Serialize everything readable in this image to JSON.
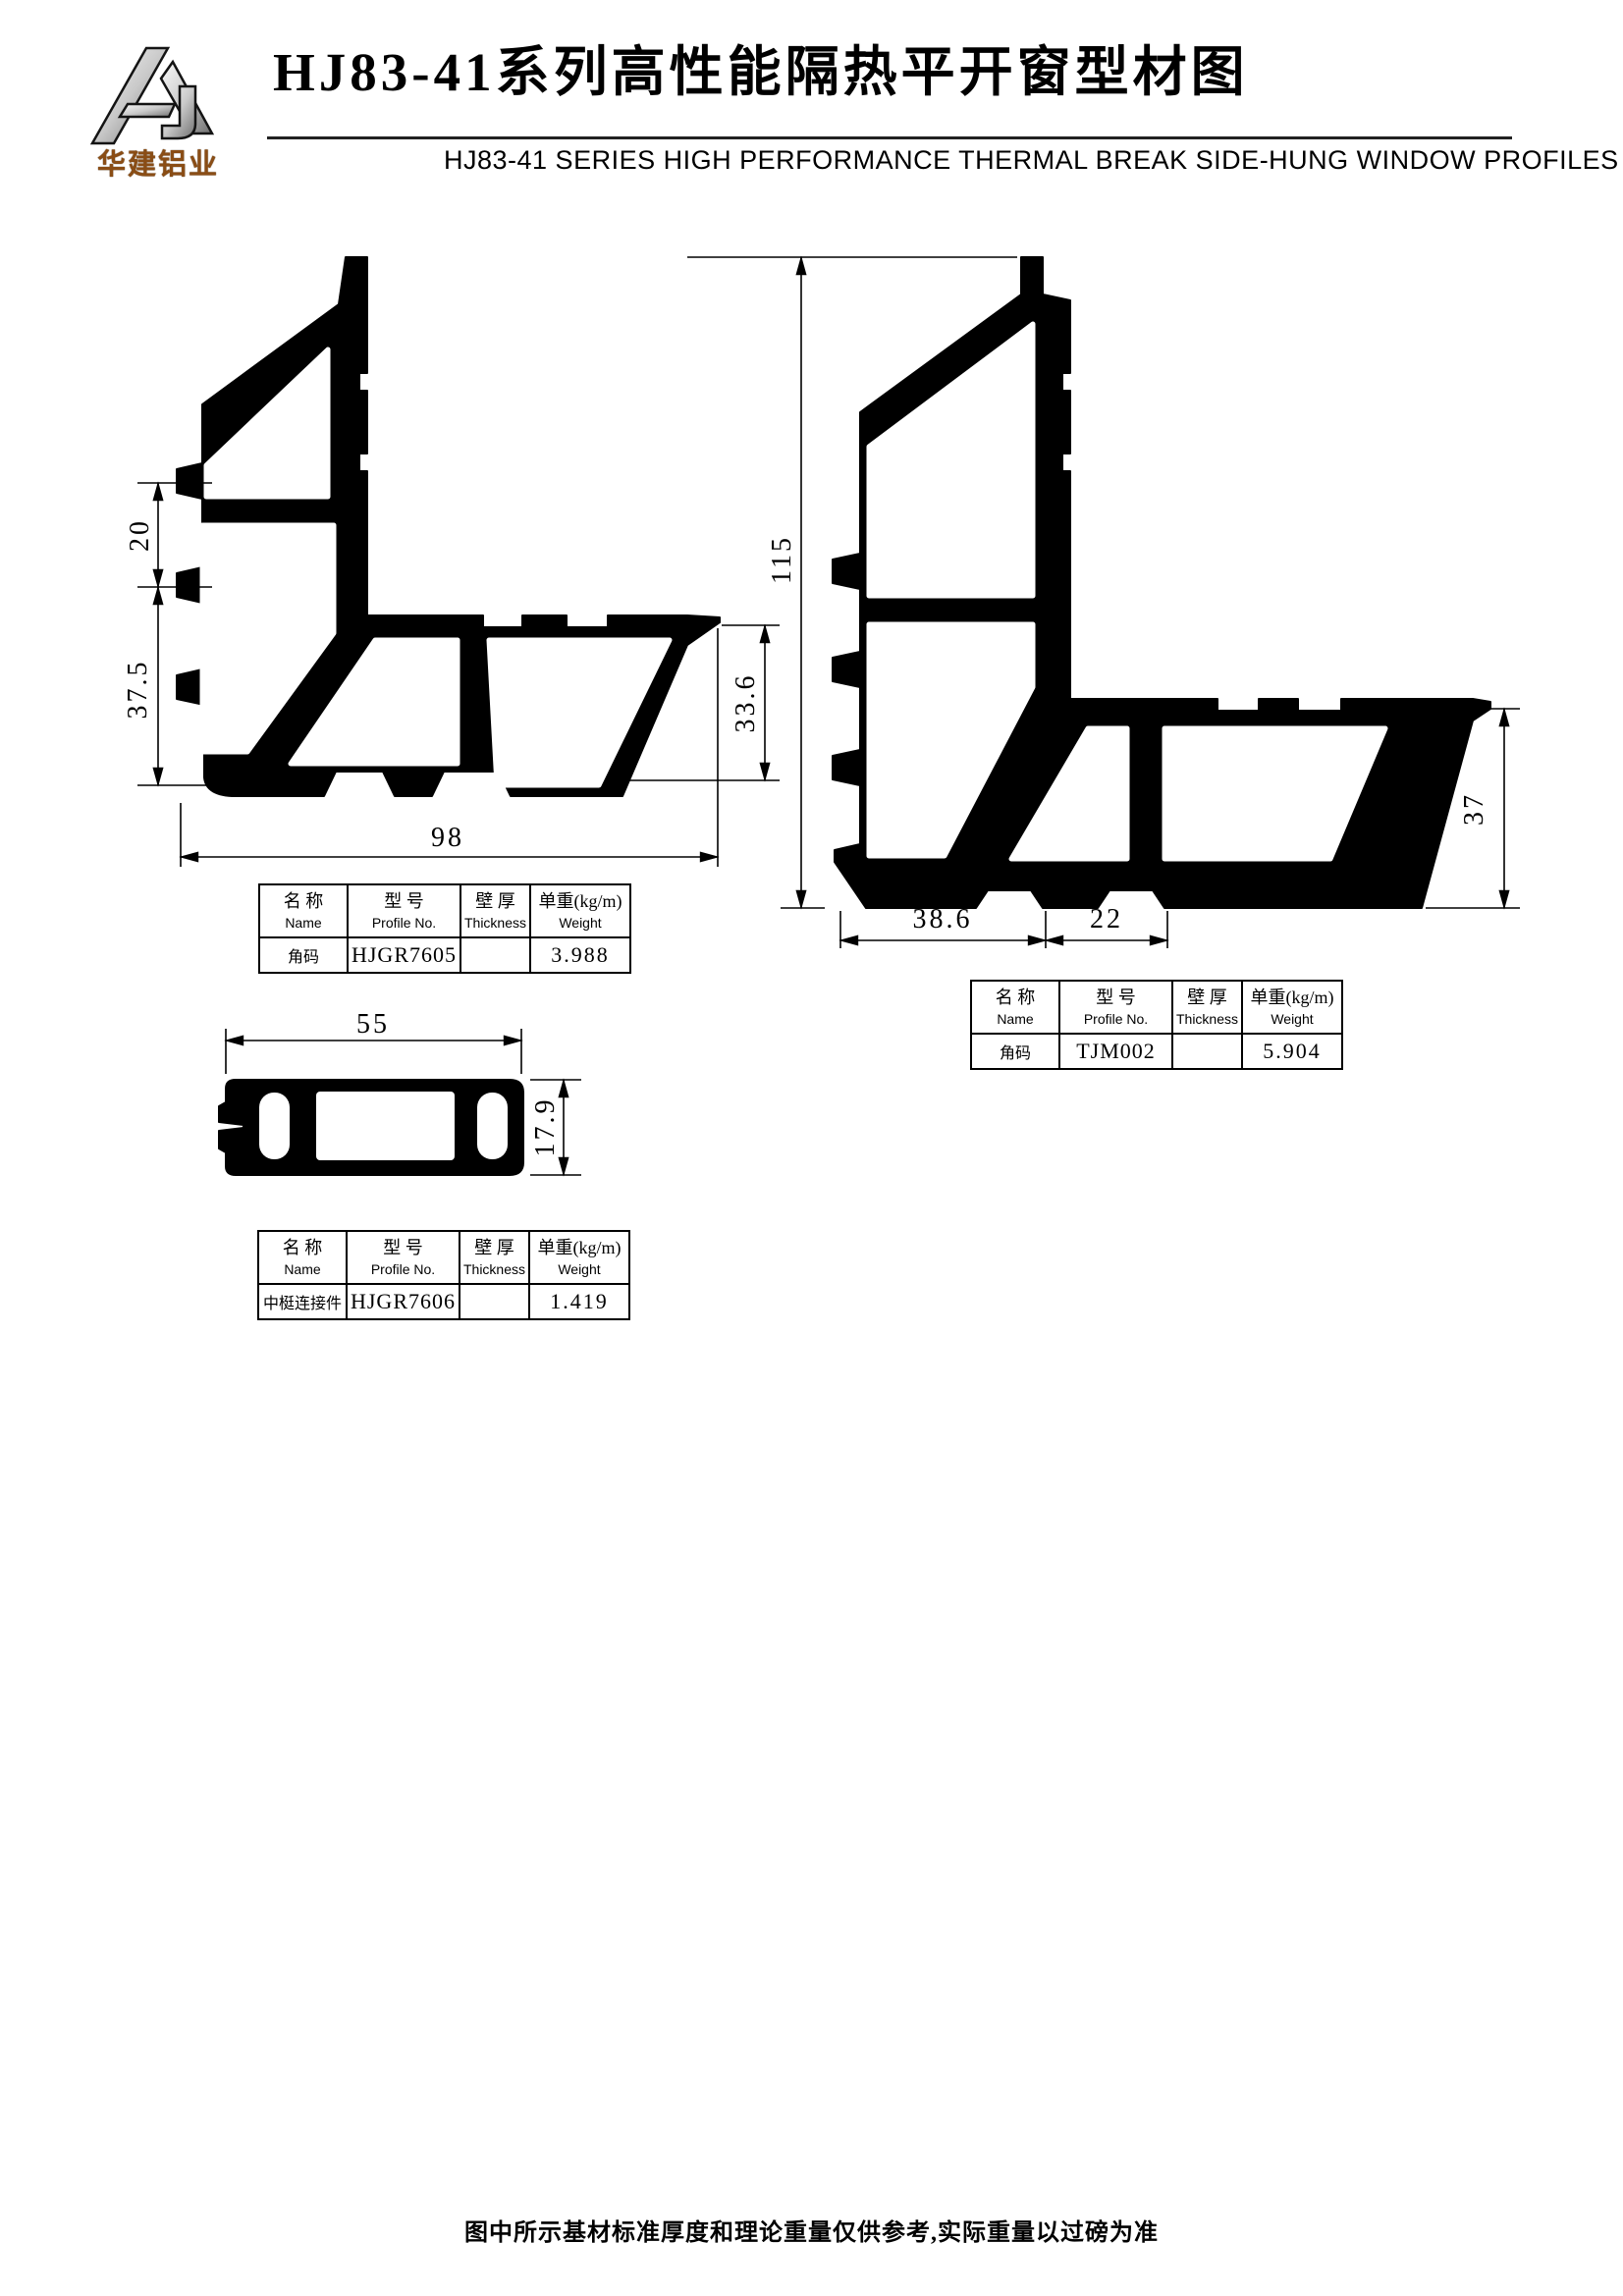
{
  "header": {
    "logo_text": "华建铝业",
    "title": "HJ83-41系列高性能隔热平开窗型材图",
    "subtitle": "HJ83-41 SERIES HIGH PERFORMANCE THERMAL BREAK SIDE-HUNG WINDOW PROFILES"
  },
  "dimensions": {
    "profile1": {
      "notch_height": "20",
      "lower_height": "37.5",
      "overall_width": "98",
      "leg_height": "33.6"
    },
    "profile2": {
      "overall_height": "115",
      "bottom_segment1": "38.6",
      "bottom_segment2": "22",
      "leg_height": "37"
    },
    "connector": {
      "width": "55",
      "height": "17.9"
    }
  },
  "table_columns": [
    {
      "zh": "名 称",
      "en": "Name"
    },
    {
      "zh": "型 号",
      "en": "Profile No."
    },
    {
      "zh": "壁 厚",
      "en": "Thickness"
    },
    {
      "zh": "单重(kg/m)",
      "en": "Weight"
    }
  ],
  "tables": {
    "t1": {
      "name": "角码",
      "profile_no": "HJGR7605",
      "thickness": "",
      "weight": "3.988"
    },
    "t2": {
      "name": "角码",
      "profile_no": "TJM002",
      "thickness": "",
      "weight": "5.904"
    },
    "t3": {
      "name": "中梃连接件",
      "profile_no": "HJGR7606",
      "thickness": "",
      "weight": "1.419"
    }
  },
  "footer": {
    "note": "图中所示基材标准厚度和理论重量仅供参考,实际重量以过磅为准"
  }
}
